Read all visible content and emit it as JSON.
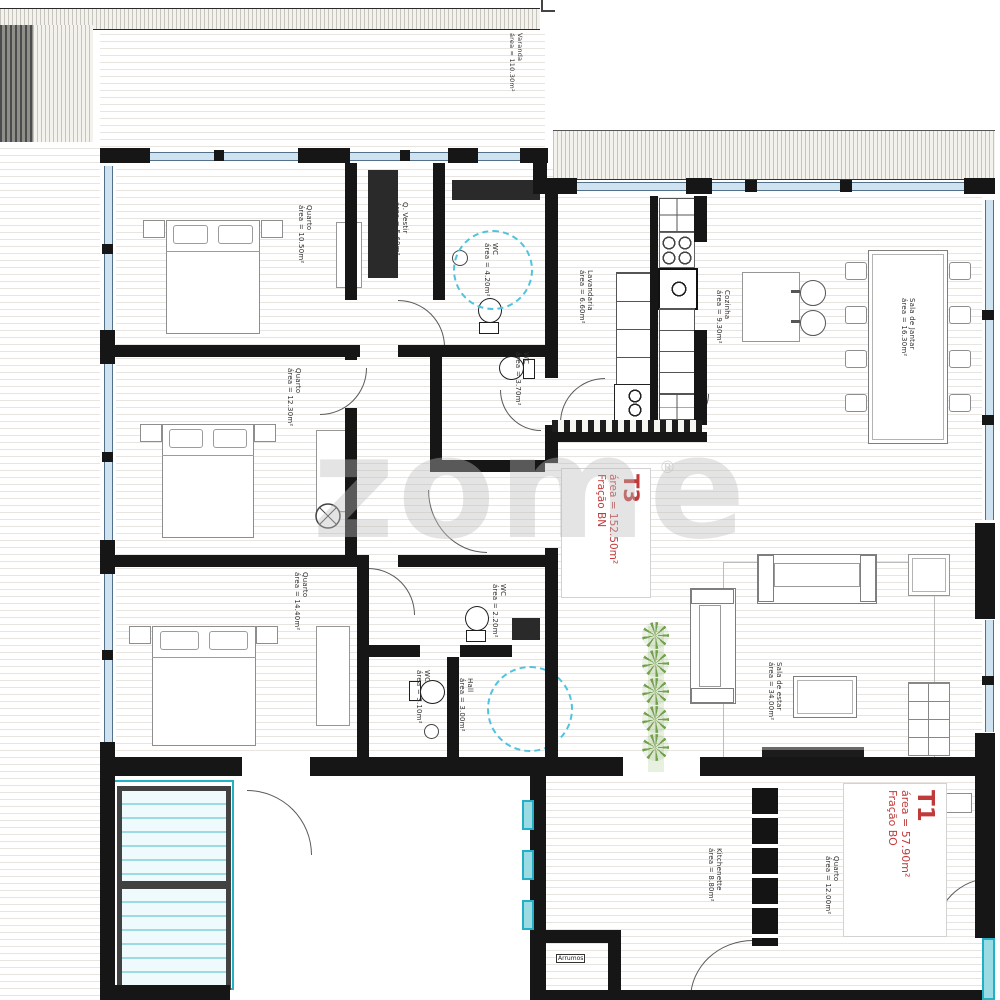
{
  "plan": {
    "watermark": "zome",
    "watermark_reg": "®",
    "colors": {
      "accent_red": "#c13a3a",
      "wall_black": "#161616",
      "window_blue": "#cfe2ef",
      "teal": "#23b0c4",
      "plant_green": "#74a052"
    },
    "fractions": {
      "t3": {
        "title": "T3",
        "area": "área = 152.50m²",
        "fraction": "Fração BN"
      },
      "t1": {
        "title": "T1",
        "area": "área = 57.90m²",
        "fraction": "Fração BO"
      }
    },
    "rooms": {
      "varanda": {
        "name": "Varanda",
        "area": "área = 110.30m²"
      },
      "quarto1": {
        "name": "Quarto",
        "area": "área = 10.50m²"
      },
      "qvestir": {
        "name": "Q. Vestir",
        "area": "área = 5.60m²"
      },
      "wc1": {
        "name": "WC",
        "area": "área = 4.20m²"
      },
      "lavandaria": {
        "name": "Lavandaria",
        "area": "área = 6.60m²"
      },
      "wc2": {
        "name": "WC",
        "area": "área = 3.70m²"
      },
      "cozinha": {
        "name": "Cozinha",
        "area": "área = 9.30m²"
      },
      "sala_jantar": {
        "name": "Sala de Jantar",
        "area": "área = 16.30m²"
      },
      "quarto2": {
        "name": "Quarto",
        "area": "área = 12.30m²"
      },
      "quarto3": {
        "name": "Quarto",
        "area": "área = 14.40m²"
      },
      "wc3": {
        "name": "WC",
        "area": "área = 2.20m²"
      },
      "wc4": {
        "name": "WC",
        "area": "área = 3.10m²"
      },
      "hall": {
        "name": "Hall",
        "area": "área = 3.00m²"
      },
      "sala_estar": {
        "name": "Sala de estar",
        "area": "área = 34.00m²"
      },
      "kitchenette": {
        "name": "Kitchenette",
        "area": "área = 8.80m²"
      },
      "quarto4": {
        "name": "Quarto",
        "area": "área = 12.00m²"
      },
      "arrumos": {
        "name": "Arrumos"
      }
    }
  }
}
